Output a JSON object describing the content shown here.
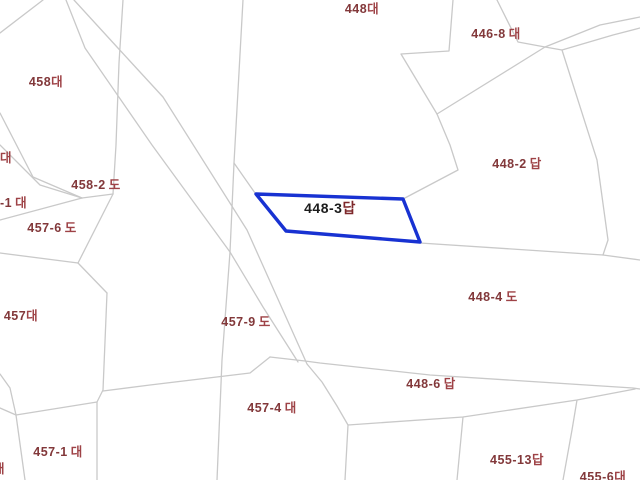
{
  "map": {
    "colors": {
      "background": "#ffffff",
      "boundary_line": "#c9c9c9",
      "label_number": "#82383a",
      "label_suffix": "#9e4246",
      "highlight_stroke": "#1832d2",
      "highlight_label_number": "#1c1c1c",
      "highlight_label_suffix": "#7e282b"
    },
    "highlight": {
      "name": "parcel-448-3",
      "points": "256,194 403,199 420,242 286,231",
      "label": {
        "number": "448-3",
        "suffix": "답",
        "x": 330,
        "y": 208
      }
    },
    "labels": [
      {
        "number": "448",
        "suffix": "대",
        "gap": false,
        "x": 362,
        "y": 9,
        "anchor": "center"
      },
      {
        "number": "446-8",
        "suffix": "대",
        "gap": true,
        "x": 496,
        "y": 34,
        "anchor": "center"
      },
      {
        "number": "458",
        "suffix": "대",
        "gap": false,
        "x": 46,
        "y": 82,
        "anchor": "center"
      },
      {
        "number": "",
        "suffix": "대",
        "gap": false,
        "x": 0,
        "y": 158,
        "anchor": "left"
      },
      {
        "number": "458-2",
        "suffix": "도",
        "gap": true,
        "x": 96,
        "y": 185,
        "anchor": "center"
      },
      {
        "number": "-1",
        "suffix": "대",
        "gap": true,
        "x": 0,
        "y": 203,
        "anchor": "left"
      },
      {
        "number": "457-6",
        "suffix": "도",
        "gap": true,
        "x": 52,
        "y": 228,
        "anchor": "center"
      },
      {
        "number": "448-2",
        "suffix": "답",
        "gap": true,
        "x": 517,
        "y": 164,
        "anchor": "center"
      },
      {
        "number": "457",
        "suffix": "대",
        "gap": false,
        "x": 21,
        "y": 316,
        "anchor": "center"
      },
      {
        "number": "457-9",
        "suffix": "도",
        "gap": true,
        "x": 246,
        "y": 322,
        "anchor": "center"
      },
      {
        "number": "448-4",
        "suffix": "도",
        "gap": true,
        "x": 493,
        "y": 297,
        "anchor": "center"
      },
      {
        "number": "448-6",
        "suffix": "답",
        "gap": true,
        "x": 431,
        "y": 384,
        "anchor": "center"
      },
      {
        "number": "457-4",
        "suffix": "대",
        "gap": true,
        "x": 272,
        "y": 408,
        "anchor": "center"
      },
      {
        "number": "457-1",
        "suffix": "대",
        "gap": true,
        "x": 58,
        "y": 452,
        "anchor": "center"
      },
      {
        "number": "455-13",
        "suffix": "답",
        "gap": false,
        "x": 517,
        "y": 460,
        "anchor": "center"
      },
      {
        "number": "455-6",
        "suffix": "대",
        "gap": false,
        "x": 603,
        "y": 477,
        "anchor": "center"
      },
      {
        "number": "",
        "suffix": "대",
        "gap": false,
        "x": -7,
        "y": 469,
        "anchor": "left"
      }
    ],
    "boundaries": [
      {
        "name": "corner-northwest",
        "points": "43,0 0,33"
      },
      {
        "name": "road-west-edge",
        "points": "66,0 85,48 152,145 230,252 263,307 298,362"
      },
      {
        "name": "road-east-edge",
        "points": "74,0 117,47 163,97 247,230 307,364 322,382 337,406 348,425 345,480"
      },
      {
        "name": "vertical-upper-left",
        "points": "123,0 119,63 116,145 113,194"
      },
      {
        "name": "boundary-458-south-a",
        "points": "0,113 33,177 82,198"
      },
      {
        "name": "boundary-458-south-b",
        "points": "0,145 40,185 82,198"
      },
      {
        "name": "boundary-to-left-edge",
        "points": "82,198 0,220"
      },
      {
        "name": "connector-k-j2",
        "points": "82,198 113,194"
      },
      {
        "name": "boundary-457-6-upper",
        "points": "113,194 78,263"
      },
      {
        "name": "boundary-457-6-west",
        "points": "78,263 0,253"
      },
      {
        "name": "boundary-457-east-top",
        "points": "78,263 107,293"
      },
      {
        "name": "vertical-457-east",
        "points": "107,293 103,390 97,402 97,480"
      },
      {
        "name": "left-edge-to-g-a",
        "points": "0,374 10,388 16,415"
      },
      {
        "name": "left-edge-to-g-b",
        "points": "0,408 16,415"
      },
      {
        "name": "boundary-457-1-west",
        "points": "16,415 25,480"
      },
      {
        "name": "boundary-457-1-north",
        "points": "16,415 97,402"
      },
      {
        "name": "boundary-sw-long",
        "points": "270,357 250,373 150,385 103,391"
      },
      {
        "name": "boundary-448-4-south",
        "points": "270,357 305,361 320,363 430,375 633,388 640,389"
      },
      {
        "name": "boundary-446-8-west-top",
        "points": "497,0 518,42 545,47 562,50"
      },
      {
        "name": "path-northeast-upper",
        "points": "545,47 600,25 640,17"
      },
      {
        "name": "path-northeast-lower",
        "points": "562,50 613,35 640,28"
      },
      {
        "name": "boundary-448-east",
        "points": "453,0 449,51 401,54 437,114"
      },
      {
        "name": "boundary-448-2-north",
        "points": "437,114 545,47"
      },
      {
        "name": "boundary-448-2-west",
        "points": "437,114 450,145 458,170 403,199"
      },
      {
        "name": "boundary-448-2-east",
        "points": "562,50 597,160 608,240 603,255"
      },
      {
        "name": "boundary-448-4-north",
        "points": "420,243 603,255 640,260"
      },
      {
        "name": "boundary-448-6-south",
        "points": "348,425 463,417 577,400 635,389"
      },
      {
        "name": "boundary-455-13-west",
        "points": "463,417 457,480"
      },
      {
        "name": "boundary-455-13-east",
        "points": "577,400 572,430 563,480"
      },
      {
        "name": "vertical-top-center",
        "points": "243,0 234,163 230,252"
      },
      {
        "name": "branch-to-parcel",
        "points": "234,163 255,193"
      },
      {
        "name": "vertical-mid-south",
        "points": "230,252 222,360 217,480"
      }
    ]
  }
}
